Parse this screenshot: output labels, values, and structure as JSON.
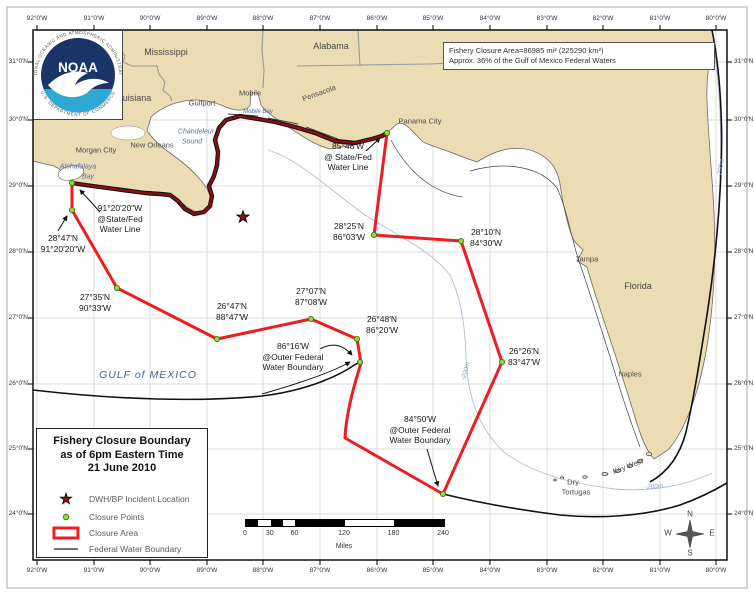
{
  "info_box": {
    "line1": "Fishery Closure Area=86985 mi² (225290 km²)",
    "line2": "Approx. 36% of the Gulf of Mexico Federal Waters"
  },
  "title_box": {
    "line1": "Fishery Closure Boundary",
    "line2": "as of 6pm Eastern Time",
    "line3": "21 June 2010"
  },
  "legend": {
    "incident": "DWH/BP Incident Location",
    "closure_points": "Closure Points",
    "closure_area": "Closure Area",
    "federal_boundary": "Federal Water Boundary"
  },
  "scale_bar": {
    "t0": "0",
    "t30": "30",
    "t60": "60",
    "t120": "120",
    "t180": "180",
    "t240": "240",
    "unit": "Miles"
  },
  "compass": {
    "n": "N",
    "s": "S",
    "e": "E",
    "w": "W"
  },
  "noaa": {
    "acronym": "NOAA",
    "ring_top": "NATIONAL OCEANIC AND ATMOSPHERIC ADMINISTRATION",
    "ring_bottom": "U.S. DEPARTMENT OF COMMERCE"
  },
  "axis": {
    "lon": [
      "92°0'W",
      "91°0'W",
      "90°0'W",
      "89°0'W",
      "88°0'W",
      "87°0'W",
      "86°0'W",
      "85°0'W",
      "84°0'W",
      "83°0'W",
      "82°0'W",
      "81°0'W",
      "80°0'W"
    ],
    "lat": [
      "31°0'N",
      "30°0'N",
      "29°0'N",
      "28°0'N",
      "27°0'N",
      "26°0'N",
      "25°0'N",
      "24°0'N"
    ]
  },
  "labels": {
    "states": {
      "mississippi": "Mississippi",
      "alabama": "Alabama",
      "louisiana": "Louisiana",
      "florida": "Florida"
    },
    "cities": {
      "mobile": "Mobile",
      "gulfport": "Gulfport",
      "new_orleans": "New Orleans",
      "morgan_city": "Morgan City",
      "pensacola": "Pensacola",
      "panama_city": "Panama City",
      "tampa": "Tampa",
      "naples": "Naples",
      "key_west": "Key West",
      "dry_tortugas_1": "Dry",
      "dry_tortugas_2": "Tortugas"
    },
    "water": {
      "gulf": "GULF of MEXICO",
      "chandeleur_1": "Chandeleur",
      "chandeleur_2": "Sound",
      "atchafalaya_1": "Atchafalaya",
      "atchafalaya_2": "Bay",
      "mobile_bay": "Mobile Bay",
      "contour_mid": "-200m",
      "contour_keys": "-200m",
      "contour_atl": "-200m"
    }
  },
  "callouts": {
    "c1": {
      "l1": "91°20'20\"W",
      "l2": "@State/Fed",
      "l3": "Water Line"
    },
    "c2": {
      "l1": "28°47'N",
      "l2": "91°20'20\"W"
    },
    "c3": {
      "l1": "27°35'N",
      "l2": "90°33'W"
    },
    "c4": {
      "l1": "26°47'N",
      "l2": "88°47'W"
    },
    "c5": {
      "l1": "27°07'N",
      "l2": "87°08'W"
    },
    "c6": {
      "l1": "26°48'N",
      "l2": "86°20'W"
    },
    "c7": {
      "l1": "86°16'W",
      "l2": "@Outer Federal",
      "l3": "Water Boundary"
    },
    "c8": {
      "l1": "84°50'W",
      "l2": "@Outer Federal",
      "l3": "Water Boundary"
    },
    "c9": {
      "l1": "26°26'N",
      "l2": "83°47'W"
    },
    "c10": {
      "l1": "28°10'N",
      "l2": "84°30'W"
    },
    "c11": {
      "l1": "28°25'N",
      "l2": "86°03'W"
    },
    "c12": {
      "l1": "85°48'W",
      "l2": "@ State/Fed",
      "l3": "Water Line"
    }
  },
  "colors": {
    "land": "#ecdcb4",
    "closure_red": "#ee1c23",
    "coastal_closure_dark_red": "#8f0d12",
    "closure_point_green": "#8ddc32",
    "incident_star_red": "#8f1014",
    "contour_blue": "#aebfd4",
    "noaa_navy": "#1a3668",
    "noaa_cyan": "#2fa8d5"
  }
}
